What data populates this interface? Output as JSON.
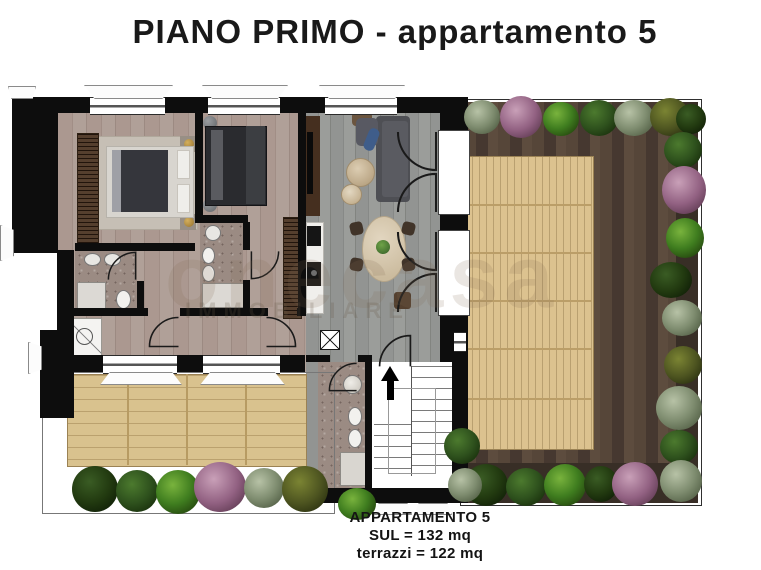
{
  "title": "PIANO PRIMO - appartamento 5",
  "watermark": {
    "brand": "onecasa",
    "subtitle": "IMMOBILIARE"
  },
  "summary": {
    "apartment": "APPARTAMENTO 5",
    "sul": "SUL = 132 mq",
    "terraces": "terrazzi = 122 mq"
  },
  "colors": {
    "wall": "#0d0d0d",
    "interior_wood": "#a8948b",
    "living_wood": "#8e908d",
    "bath_tile": "#9b8b83",
    "deck_light": "#d9c28e",
    "deck_divider": "#b79b63",
    "terrace_wood_dark": "#4f4138",
    "planter_soil": "#382e26",
    "bush_green_bright": "#3f7d1f",
    "bush_green_mid": "#2e511d",
    "bush_green_dark": "#223a10",
    "bush_sage": "#7e8c6f",
    "bush_olive": "#4d5420",
    "bush_purple": "#926182",
    "gold_lamp": "#a8843c"
  }
}
